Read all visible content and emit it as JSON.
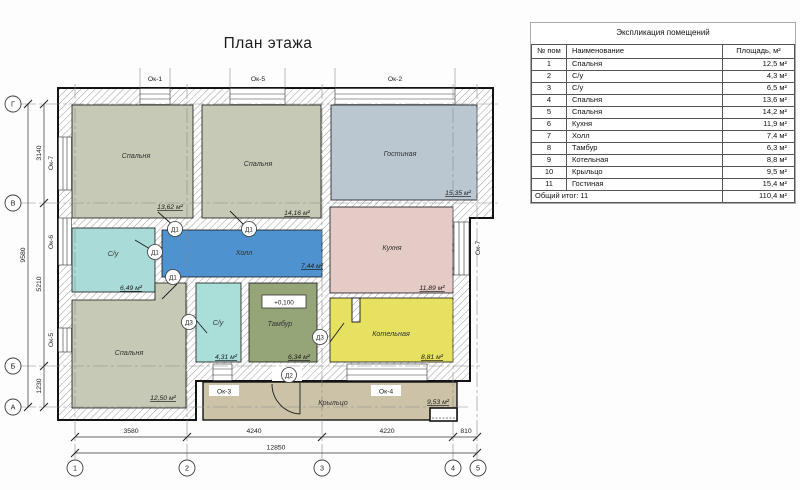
{
  "title": "План этажа",
  "plan": {
    "grid": {
      "cols": [
        "1",
        "2",
        "3",
        "4",
        "5"
      ],
      "rows": [
        "Г",
        "В",
        "Б",
        "А"
      ]
    },
    "dimensions": {
      "bottom_segments": [
        "3580",
        "4240",
        "4220",
        "810"
      ],
      "bottom_total": "12850",
      "left_segments": [
        "3140",
        "5210",
        "1230"
      ],
      "left_total": "9580"
    },
    "windows": {
      "top": [
        "Ок-1",
        "Ок-5",
        "Ок-2"
      ],
      "left": [
        "Ок-7",
        "Ок-6",
        "Ок-5"
      ],
      "right": [
        "Ок-7"
      ],
      "bottom": [
        "Ок-3",
        "Ок-4"
      ]
    },
    "doors": {
      "d1": "Д1",
      "d2": "Д2",
      "d3": "Д3"
    },
    "elevation_mark": "+0,100",
    "wall_hatch_color": "#9a9a9a",
    "rooms": [
      {
        "id": "bedroom-top-left",
        "label": "Спальня",
        "area": "13,62 м²",
        "color": "#c6c9b5"
      },
      {
        "id": "bedroom-top-middle",
        "label": "Спальня",
        "area": "14,16 м²",
        "color": "#c6c9b5"
      },
      {
        "id": "living-room",
        "label": "Гостиная",
        "area": "15,35 м²",
        "color": "#bac7d1"
      },
      {
        "id": "bathroom-left",
        "label": "С/у",
        "area": "6,49 м²",
        "color": "#a9dcd8"
      },
      {
        "id": "hall",
        "label": "Холл",
        "area": "7,44 м²",
        "color": "#4e93cf"
      },
      {
        "id": "kitchen",
        "label": "Кухня",
        "area": "11,89 м²",
        "color": "#e5cbc6"
      },
      {
        "id": "bathroom-small",
        "label": "С/у",
        "area": "4,31 м²",
        "color": "#aadfd9"
      },
      {
        "id": "tambour",
        "label": "Тамбур",
        "area": "6,34 м²",
        "color": "#95a578"
      },
      {
        "id": "boiler-room",
        "label": "Котельная",
        "area": "8,81 м²",
        "color": "#e6e161"
      },
      {
        "id": "bedroom-bottom-left",
        "label": "Спальня",
        "area": "12,50 м²",
        "color": "#c6c9b5"
      },
      {
        "id": "porch",
        "label": "Крыльцо",
        "area": "9,53 м²",
        "color": "#cbc2a7"
      }
    ]
  },
  "table": {
    "title": "Экспликация помещений",
    "columns": {
      "num": "№ пом",
      "name": "Наименование",
      "area": "Площадь, м²"
    },
    "rows": [
      {
        "num": "1",
        "name": "Спальня",
        "area": "12,5 м²"
      },
      {
        "num": "2",
        "name": "С/у",
        "area": "4,3 м²"
      },
      {
        "num": "3",
        "name": "С/у",
        "area": "6,5 м²"
      },
      {
        "num": "4",
        "name": "Спальня",
        "area": "13,6 м²"
      },
      {
        "num": "5",
        "name": "Спальня",
        "area": "14,2 м²"
      },
      {
        "num": "6",
        "name": "Кухня",
        "area": "11,9 м²"
      },
      {
        "num": "7",
        "name": "Холл",
        "area": "7,4 м²"
      },
      {
        "num": "8",
        "name": "Тамбур",
        "area": "6,3 м²"
      },
      {
        "num": "9",
        "name": "Котельная",
        "area": "8,8 м²"
      },
      {
        "num": "10",
        "name": "Крыльцо",
        "area": "9,5 м²"
      },
      {
        "num": "11",
        "name": "Гостиная",
        "area": "15,4 м²"
      }
    ],
    "total_label": "Общий итог: 11",
    "total_area": "110,4 м²"
  }
}
